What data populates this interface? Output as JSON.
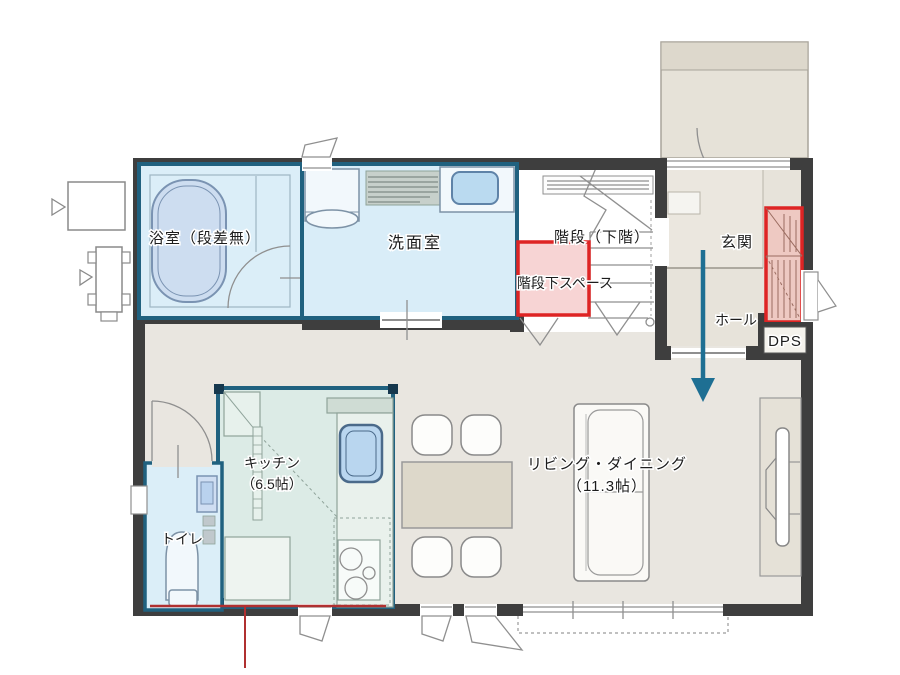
{
  "plan": {
    "rooms": {
      "bath": {
        "label": "浴室（段差無）"
      },
      "washroom": {
        "label": "洗面室"
      },
      "stairs": {
        "label": "階段（下階）"
      },
      "under_stairs": {
        "label": "階段下スペース"
      },
      "entrance": {
        "label": "玄関"
      },
      "hall": {
        "label": "ホール"
      },
      "dps": {
        "label": "DPS"
      },
      "kitchen": {
        "label": "キッチン",
        "size": "（6.5帖）"
      },
      "toilet": {
        "label": "トイレ"
      },
      "living_dining": {
        "label": "リビング・ダイニング",
        "size": "（11.3帖）"
      }
    },
    "colors": {
      "wall": "#3e3e3e",
      "floor": "#e9e6e0",
      "entrance_floor": "#e7e3da",
      "wet_room_fill": "#d9edf8",
      "kitchen_fill": "#dcebe6",
      "wet_room_border": "#20617f",
      "highlight_red": "#de2424",
      "highlight_pink_fill": "#f7d4d4",
      "shoe_closet_fill": "#eec9c2",
      "flow_arrow": "#1e6f93",
      "section_line_red": "#b03030"
    }
  }
}
